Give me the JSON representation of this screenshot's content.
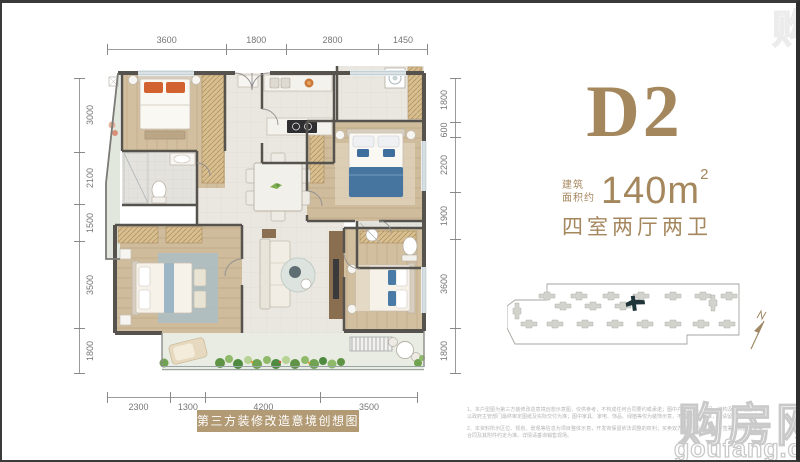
{
  "unit": {
    "name": "D2",
    "area_prefix_line1": "建筑",
    "area_prefix_line2": "面积约",
    "area_value": "140m",
    "area_sup": "2",
    "layout": "四室两厅两卫"
  },
  "caption": {
    "text": "第三方装修改造意境创想图"
  },
  "dimensions": {
    "top": {
      "values": [
        3600,
        1800,
        2800,
        1450
      ]
    },
    "bottom": {
      "values": [
        2300,
        1300,
        4200,
        3500
      ]
    },
    "left": {
      "values": [
        3000,
        2100,
        1500,
        3500,
        1800
      ]
    },
    "right": {
      "values": [
        1800,
        600,
        2200,
        1900,
        3600,
        1800
      ]
    }
  },
  "site_plan": {
    "building_color": "#d3d3cd",
    "highlight_color": "#20353a",
    "north_label": "N"
  },
  "watermark": {
    "cn": "购房网",
    "en": "goufang.com"
  },
  "disclaimer": {
    "p1": "1、本户型图为第三方装修改造意境创想示意图，仅供参考，不构成任何合同要约或承诺；图中户型尺寸、开间、结构及管线位置等均以政府主管部门最终审定图纸及实际交付为准；图中家具、家电、饰品、绿植等仅为装饰示意，不属于交付标准，敬请留意。",
    "p2": "2、本资料所示区位、规划、景观等信息为项目整体示意，开发商保留依法调整的权利；买卖双方的权利义务以双方签署的商品房买卖合同及其附件约定为准。详情请垂询销售现场。"
  }
}
